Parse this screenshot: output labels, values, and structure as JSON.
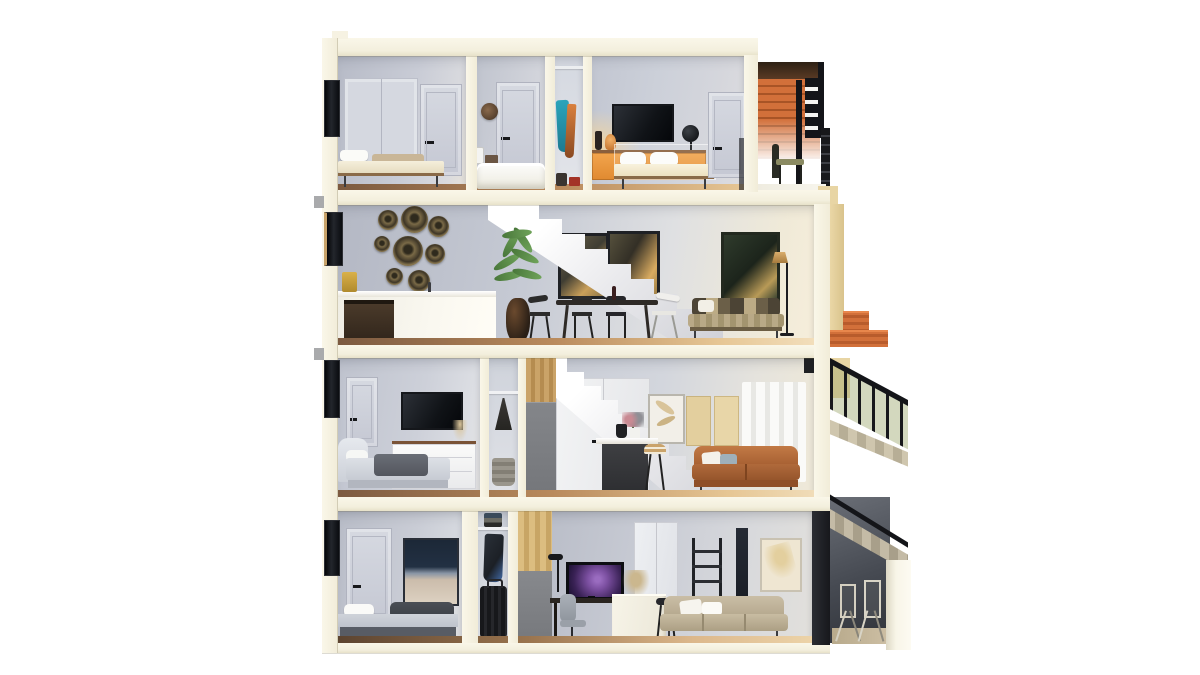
{
  "scene": {
    "kind": "3d-architectural-cutaway-render",
    "subject": "Dollhouse cross-section of a four-storey townhouse with roof deck and exterior metal stairs",
    "background": "#ffffff",
    "palette": {
      "cut_wall_cream": "#f8f4e4",
      "interior_wall_gray": "#c7cbd5",
      "wood_floor": "#a97e54",
      "deck_slat_wood": "#d2703a",
      "sideboard_orange": "#ef9c42",
      "tan_facade": "#e8d5a4",
      "metal_black": "#17181b",
      "leather_sofa_brown": "#b06a3b",
      "stair_white": "#f2f2f4",
      "tv_screen_dark": "#101317",
      "monitor_glow_purple": "#7b4fa0",
      "plant_green": "#5f9148",
      "teal_garment": "#2ba4bb",
      "navy_artwork": "#1c2837"
    },
    "floors": [
      {
        "level": 4,
        "name": "top-floor",
        "rooms": [
          "bedroom-left",
          "bathroom",
          "wardrobe-nook",
          "bedroom-right",
          "roof-deck"
        ],
        "objects": [
          "closet-double-doors",
          "daybed",
          "interior-door",
          "wall-clock",
          "bathtub",
          "soap-bottles",
          "hanging-teal-and-orange-clothes",
          "storage-boxes",
          "wall-tv",
          "orange-sideboard",
          "double-bed-white-pillows",
          "black-globe",
          "deck-slat-wall",
          "deck-chair",
          "deck-railing"
        ]
      },
      {
        "level": 3,
        "name": "kitchen-dining-living-floor",
        "rooms": [
          "open-plan-kitchen-dining-living"
        ],
        "objects": [
          "white-kitchen-counter",
          "dark-appliance",
          "decorative-wall-plates",
          "utensil-cup",
          "white-staircase",
          "potted-palm",
          "framed-art-pair",
          "dining-table-with-chairs",
          "patterned-sofa",
          "floor-lamp",
          "dark-green-artwork",
          "exterior-terracotta-steps"
        ]
      },
      {
        "level": 2,
        "name": "bedroom-and-kitchenette-floor",
        "rooms": [
          "bedroom-left",
          "closet-nook",
          "open-stair-kitchenette-living"
        ],
        "objects": [
          "wall-tv",
          "white-dresser",
          "bed-gray-blanket",
          "hanging-bag",
          "laundry-basket",
          "wood-panel-corner",
          "gray-cabinet",
          "white-staircase",
          "under-stair-closet-doors",
          "kitchen-island-dark",
          "bar-stools",
          "flower-vase",
          "feather-artwork",
          "tan-wall-panels",
          "leather-sofa",
          "white-curtains",
          "exterior-black-railing"
        ]
      },
      {
        "level": 1,
        "name": "ground-floor",
        "rooms": [
          "bedroom-left",
          "closet-nook",
          "home-office-living"
        ],
        "objects": [
          "framed-seascape-art",
          "single-bed-dark-blanket",
          "folded-clothes-shelf",
          "hanging-coat",
          "suitcase",
          "wood-panel",
          "gray-panel",
          "desk-with-monitor",
          "desk-lamp",
          "office-chair",
          "white-island-with-plant",
          "bar-stool",
          "double-door",
          "ladder-shelf",
          "pampas-artwork",
          "beige-sofa",
          "exterior-stair-underside",
          "patio-folding-chairs",
          "white-pillar"
        ]
      }
    ],
    "exterior": {
      "left_windows": 4,
      "right_side": [
        "roof-deck-railing",
        "terracotta-steps",
        "black-metal-staircase",
        "patio"
      ]
    }
  }
}
